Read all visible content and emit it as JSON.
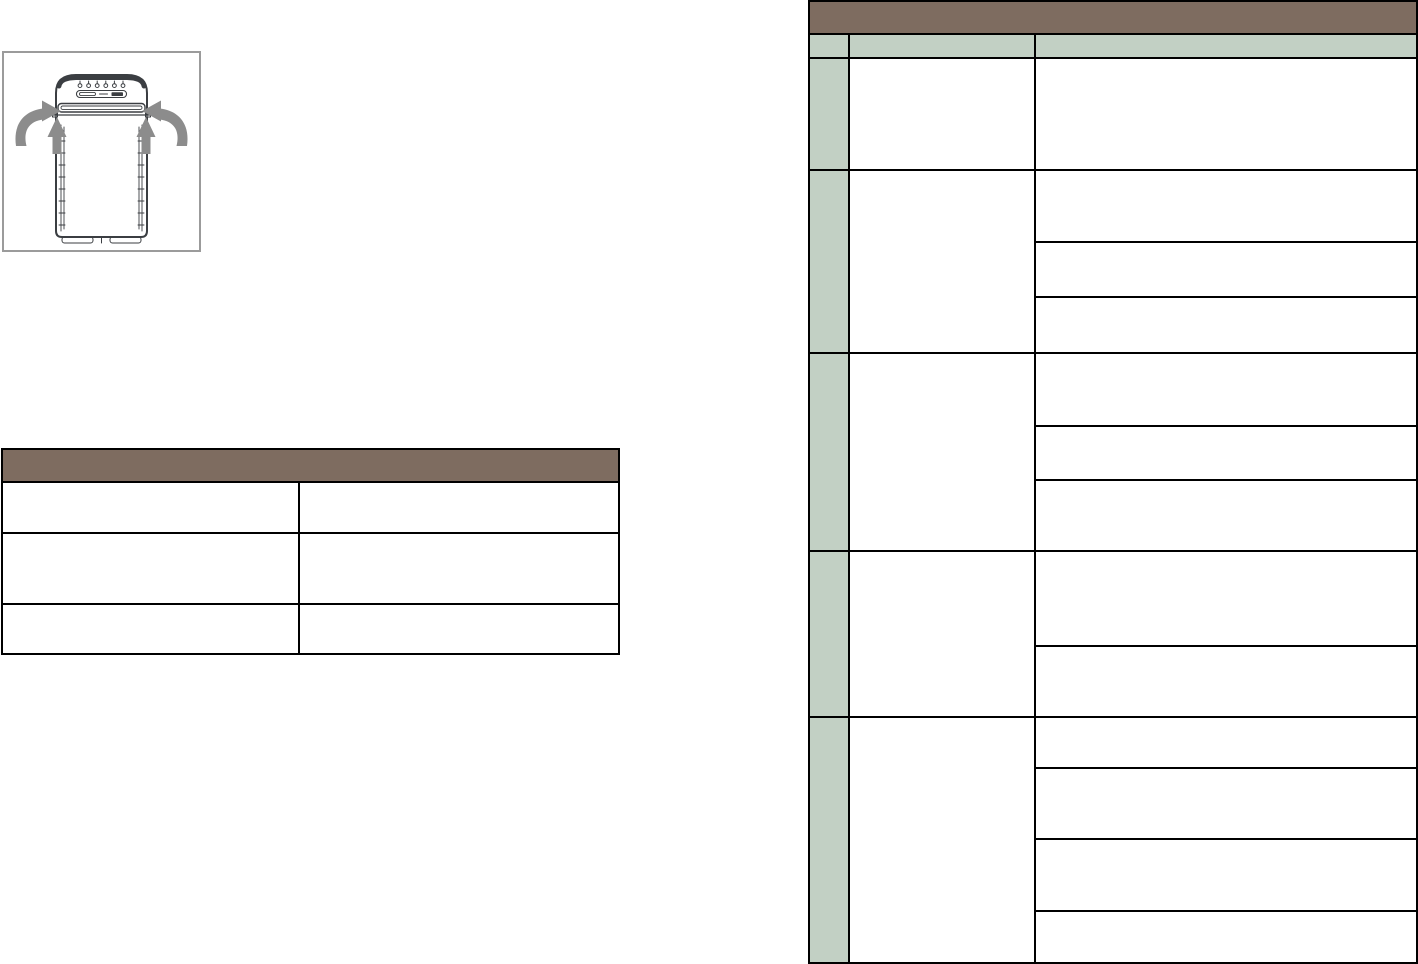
{
  "page": {
    "background_color": "#ffffff"
  },
  "colors": {
    "page_bg": "#ffffff",
    "section_header_bg": "#7E6C60",
    "subheader_bg": "#C2D0C4",
    "row_label_bg": "#C2D0C4",
    "table_border": "#000000",
    "figure_border": "#9B9B9B",
    "arrow_color": "#8C8C8C",
    "device_outline": "#3B3E42"
  },
  "figure": {
    "caption": "",
    "icons": [
      "air-purifier-front-view",
      "curved-inward-airflow-arrow-left",
      "curved-inward-airflow-arrow-right",
      "upward-airflow-arrow-left",
      "upward-airflow-arrow-right",
      "control-panel-buttons",
      "air-outlet-slot"
    ]
  },
  "left_table": {
    "title": "",
    "rows": [
      [
        "",
        ""
      ],
      [
        "",
        ""
      ],
      [
        "",
        ""
      ]
    ]
  },
  "right_table": {
    "title": "",
    "columns": [
      "",
      "",
      ""
    ],
    "groups": [
      {
        "label": "",
        "middle": "",
        "details": [
          ""
        ]
      },
      {
        "label": "",
        "middle": "",
        "details": [
          "",
          "",
          ""
        ]
      },
      {
        "label": "",
        "middle": "",
        "details": [
          "",
          "",
          ""
        ]
      },
      {
        "label": "",
        "middle": "",
        "details": [
          "",
          ""
        ]
      },
      {
        "label": "",
        "middle": "",
        "details": [
          "",
          "",
          "",
          ""
        ]
      }
    ]
  }
}
